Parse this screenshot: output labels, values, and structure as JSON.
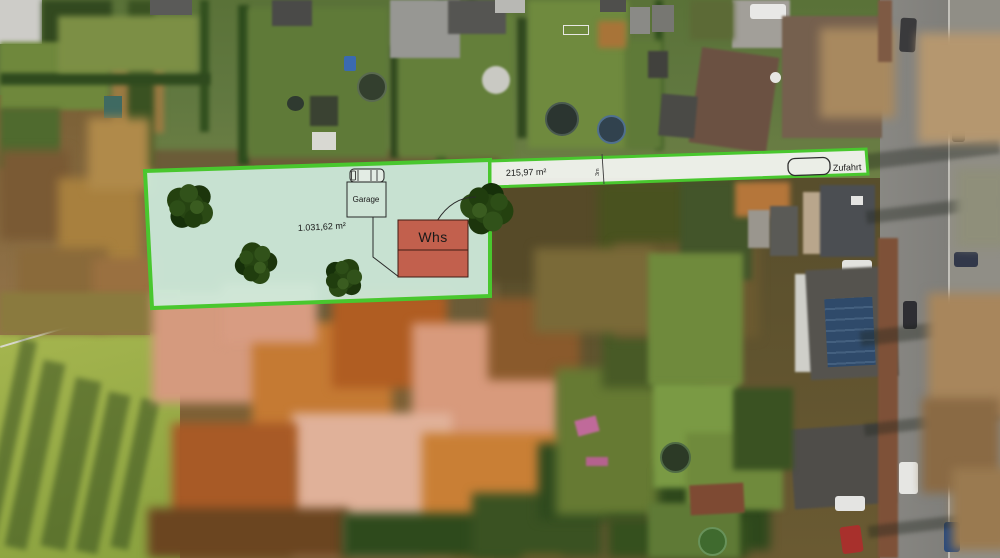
{
  "overlay": {
    "plot": {
      "area_label": "1.031,62 m²"
    },
    "strip": {
      "area_label": "215,97 m²",
      "zufahrt_label": "Zufahrt",
      "width_label": "3m"
    },
    "garage_label": "Garage",
    "house_label": "Whs",
    "colors": {
      "plot_fill": "#cfecdd",
      "plot_border": "#49c72e",
      "strip_fill": "#f3f5f1",
      "house_fill": "#c2604d",
      "house_border": "#401b12",
      "tree_dark": "#264412"
    }
  }
}
